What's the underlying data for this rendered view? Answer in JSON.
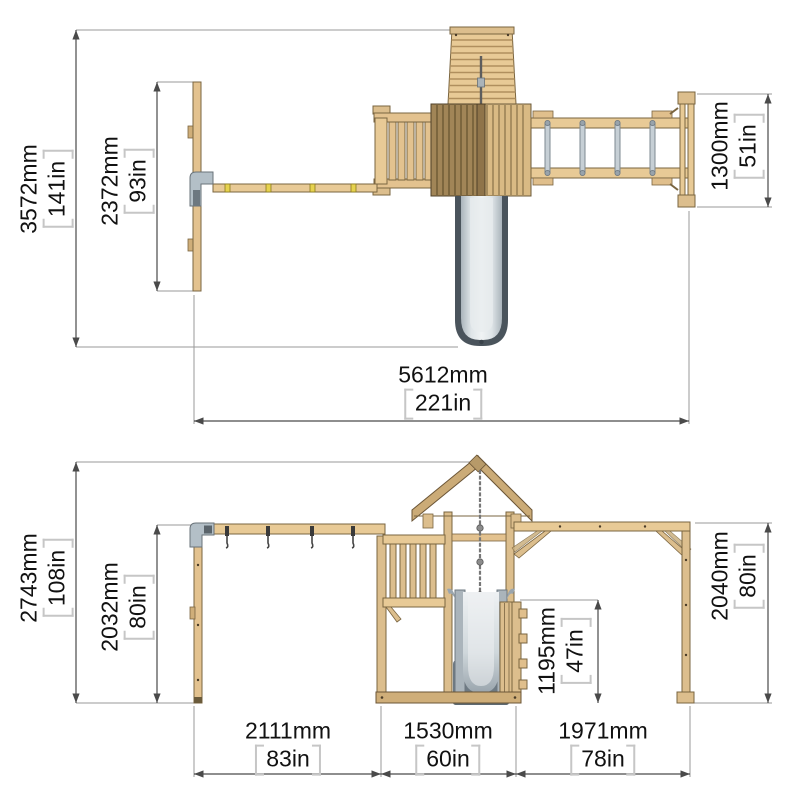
{
  "drawing_title": "playset-dimension-diagram",
  "colors": {
    "wood_light": "#e8ca96",
    "wood_mid": "#dcbe8d",
    "wood_base": "#cfae79",
    "roof_dark_half": "#a18557",
    "roof_light_half": "#d9ba84",
    "outline": "#6b5536",
    "slide_light": "#dfe5e8",
    "slide_mid": "#aeb9c0",
    "slide_dark": "#5e6a73",
    "metal_rung": "#c6cfd5",
    "bracket_gray": "#b3bfc7",
    "hanger_yellow": "#e6d24e",
    "dim_line": "#4a4a4a",
    "ext_line": "#9a9a9a",
    "text": "#111111"
  },
  "top_view": {
    "dimensions": {
      "total_depth": {
        "mm": "3572mm",
        "in": "141in"
      },
      "swing_frame_depth": {
        "mm": "2372mm",
        "in": "93in"
      },
      "monkeybar_depth": {
        "mm": "1300mm",
        "in": "51in"
      },
      "total_width": {
        "mm": "5612mm",
        "in": "221in"
      }
    }
  },
  "front_view": {
    "dimensions": {
      "total_height": {
        "mm": "2743mm",
        "in": "108in"
      },
      "swing_beam_height": {
        "mm": "2032mm",
        "in": "80in"
      },
      "platform_height": {
        "mm": "1195mm",
        "in": "47in"
      },
      "monkeybar_height": {
        "mm": "2040mm",
        "in": "80in"
      },
      "swing_section_width": {
        "mm": "2111mm",
        "in": "83in"
      },
      "tower_section_width": {
        "mm": "1530mm",
        "in": "60in"
      },
      "monkeybar_section_width": {
        "mm": "1971mm",
        "in": "78in"
      }
    }
  }
}
